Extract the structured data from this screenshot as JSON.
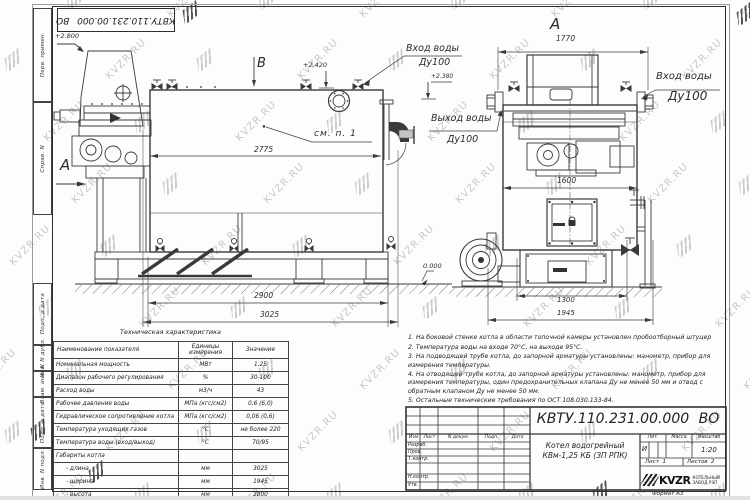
{
  "watermark": {
    "text": "KVZR.RU",
    "logo_icon": "kvzr-logo-icon"
  },
  "frame": {
    "top_designation": "КВТУ.110.231.00.000 ВО",
    "left_margin_labels": [
      "Перв. примен.",
      "Справ. N",
      "Подп. и дата",
      "Инв. N дубл.",
      "Взам. инв. N",
      "Подп. и дата",
      "Инв. N подл."
    ],
    "format_note": "Формат  А3"
  },
  "views": {
    "side_view": {
      "view_a": "A",
      "view_b": "B",
      "elev_top": "+2.800",
      "elev_manhole": "+2.420",
      "elev_inlet": "+2.380",
      "elev_ground": "0.000",
      "inlet_label": "Вход воды",
      "inlet_dn": "Ду100",
      "outlet_label": "Выход воды",
      "outlet_dn": "Ду100",
      "see_note": "см. п. 1",
      "dim_inner_length": "2775",
      "dim_base_length": "2900",
      "dim_overall_length": "3025"
    },
    "front_view": {
      "view_label": "A",
      "inlet_label": "Вход воды",
      "inlet_dn": "Ду100",
      "dim_top_width": "1770",
      "dim_body_width": "1600",
      "dim_base_width": "1300",
      "dim_overall_width": "1945"
    }
  },
  "tech_table": {
    "title": "Техническая характеристика",
    "headers": [
      "Наименование показателя",
      "Единицы измерения",
      "Значение"
    ],
    "rows": [
      [
        "Номинальная мощность",
        "МВт",
        "1,25"
      ],
      [
        "Диапазон рабочего регулирования",
        "%",
        "30-100"
      ],
      [
        "Расход воды",
        "м3/ч",
        "43"
      ],
      [
        "Рабочее давление воды",
        "МПа (кгс/см2)",
        "0,6 (6,0)"
      ],
      [
        "Гидравлическое сопротивление котла",
        "МПа (кгс/см2)",
        "0,06 (0,6)"
      ],
      [
        "Температура уходящих газов",
        "°С",
        "не более 220"
      ],
      [
        "Температура воды (вход/выход)",
        "°С",
        "70/95"
      ],
      [
        "Габариты котла",
        "",
        ""
      ],
      [
        "- длина",
        "мм",
        "3025"
      ],
      [
        "- ширина",
        "мм",
        "1945"
      ],
      [
        "- высота",
        "мм",
        "2800"
      ]
    ]
  },
  "notes": {
    "items": [
      "1.  На боковой стенке котла в области топочной камеры установлен пробоотборный штуцер",
      "2.  Температура воды на входе 70°С, на выходе 95°С.",
      "3.  На подводящей трубе котла, до запорной арматуры установлены: манометр, прибор для измерения температуры.",
      "4.  На отводящей трубе котла, до запорной арматуры установлены: манометр, прибор для измерения температуры, один предохранительных клапана Ду не менее 50 мм и отвод с обратным клапаном Ду не менее 50 мм.",
      "5.  Остальные технические требования по ОСТ 108.030.133-84."
    ]
  },
  "title_block": {
    "designation": "КВТУ.110.231.00.000 ВО",
    "signature_header": [
      "Изм",
      "Лист",
      "N докум.",
      "Подп.",
      "Дата"
    ],
    "signature_rows": [
      "Разраб.",
      "Пров.",
      "Т.контр.",
      "Н.контр.",
      "Утв."
    ],
    "product_name_line1": "Котел водогрейный",
    "product_name_line2": "КВм-1,25 КБ (ЗП РПК)",
    "lit_label": "Лит.",
    "mass_label": "Масса",
    "scale_label": "Масштаб",
    "lit_value": "И",
    "scale_value": "1:20",
    "sheet_label": "Лист",
    "sheet_value": "1",
    "sheets_label": "Листов",
    "sheets_value": "2",
    "company_logo_text": "KVZR",
    "company_name_line1": "КОТЕЛЬНЫЙ",
    "company_name_line2": "ЗАВОД РЭП"
  }
}
